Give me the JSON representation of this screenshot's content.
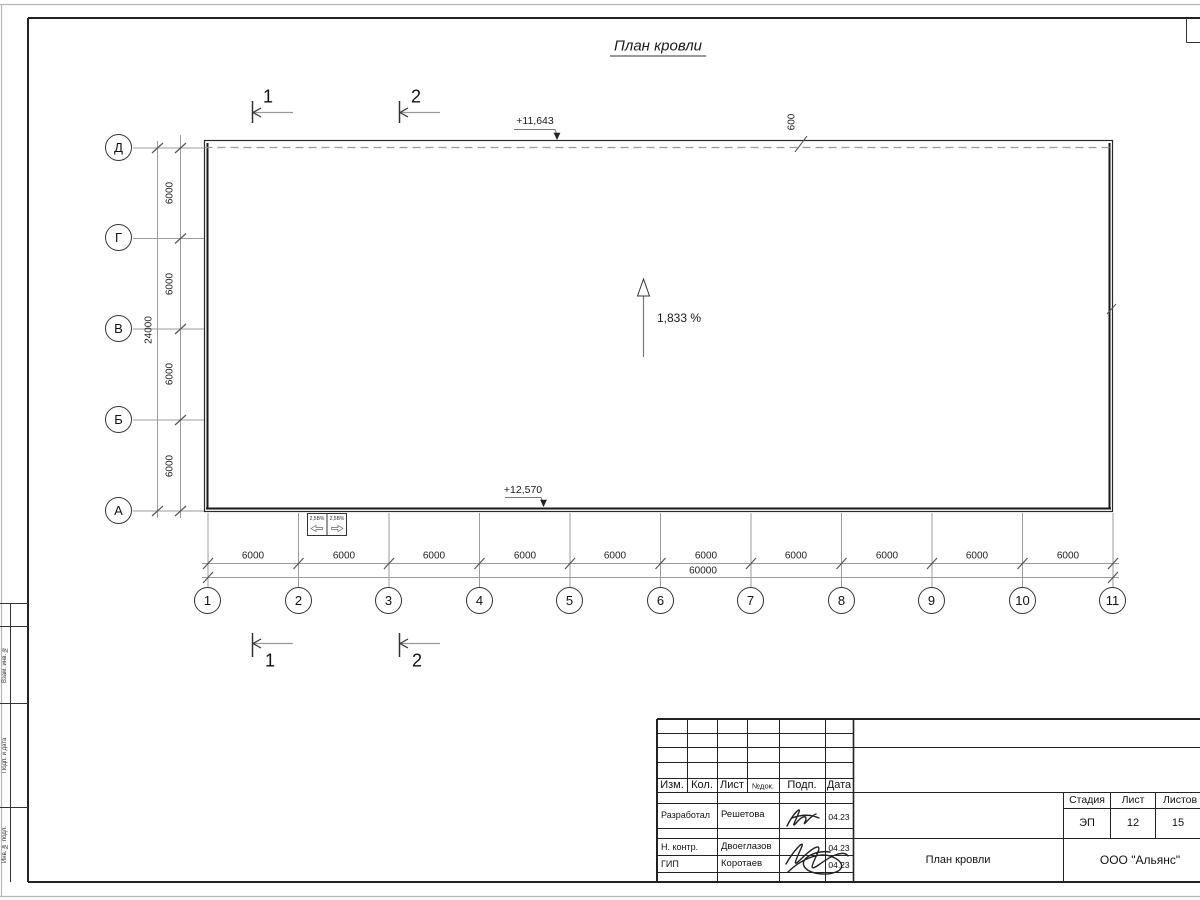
{
  "sheet": {
    "title": "План кровли",
    "slope_label": "1,833 %",
    "elevation_top": "+11,643",
    "elevation_bottom": "+12,570",
    "overhang_dim": "600",
    "section_1": "1",
    "section_2": "2"
  },
  "axes": {
    "bottom": [
      "1",
      "2",
      "3",
      "4",
      "5",
      "6",
      "7",
      "8",
      "9",
      "10",
      "11"
    ],
    "left": [
      "Д",
      "Г",
      "В",
      "Б",
      "А"
    ]
  },
  "dims": {
    "bottom_intervals": [
      "6000",
      "6000",
      "6000",
      "6000",
      "6000",
      "6000",
      "6000",
      "6000",
      "6000",
      "6000"
    ],
    "bottom_total": "60000",
    "left_intervals": [
      "6000",
      "6000",
      "6000",
      "6000"
    ],
    "left_total": "24000"
  },
  "funnels": [
    "2,5В%",
    "2,5В%"
  ],
  "titleblock": {
    "col_izm": "Изм.",
    "col_kol": "Кол.",
    "col_list": "Лист",
    "col_ndok": "№док.",
    "col_podp": "Подп.",
    "col_data": "Дата",
    "rows": [
      {
        "role": "Разработал",
        "name": "Решетова",
        "date": "04.23"
      },
      {
        "role": "Н. контр.",
        "name": "Двоеглазов",
        "date": "04.23"
      },
      {
        "role": "ГИП",
        "name": "Коротаев",
        "date": "04.23"
      }
    ],
    "stage_label": "Стадия",
    "list_label": "Лист",
    "listov_label": "Листов",
    "stage": "ЭП",
    "list_no": "12",
    "listov": "15",
    "doc_name": "План кровли",
    "company": "ООО \"Альянс\""
  },
  "margin": {
    "labels": [
      "Взам. инв. №",
      "Подп. и дата",
      "Инв. № подл."
    ]
  }
}
